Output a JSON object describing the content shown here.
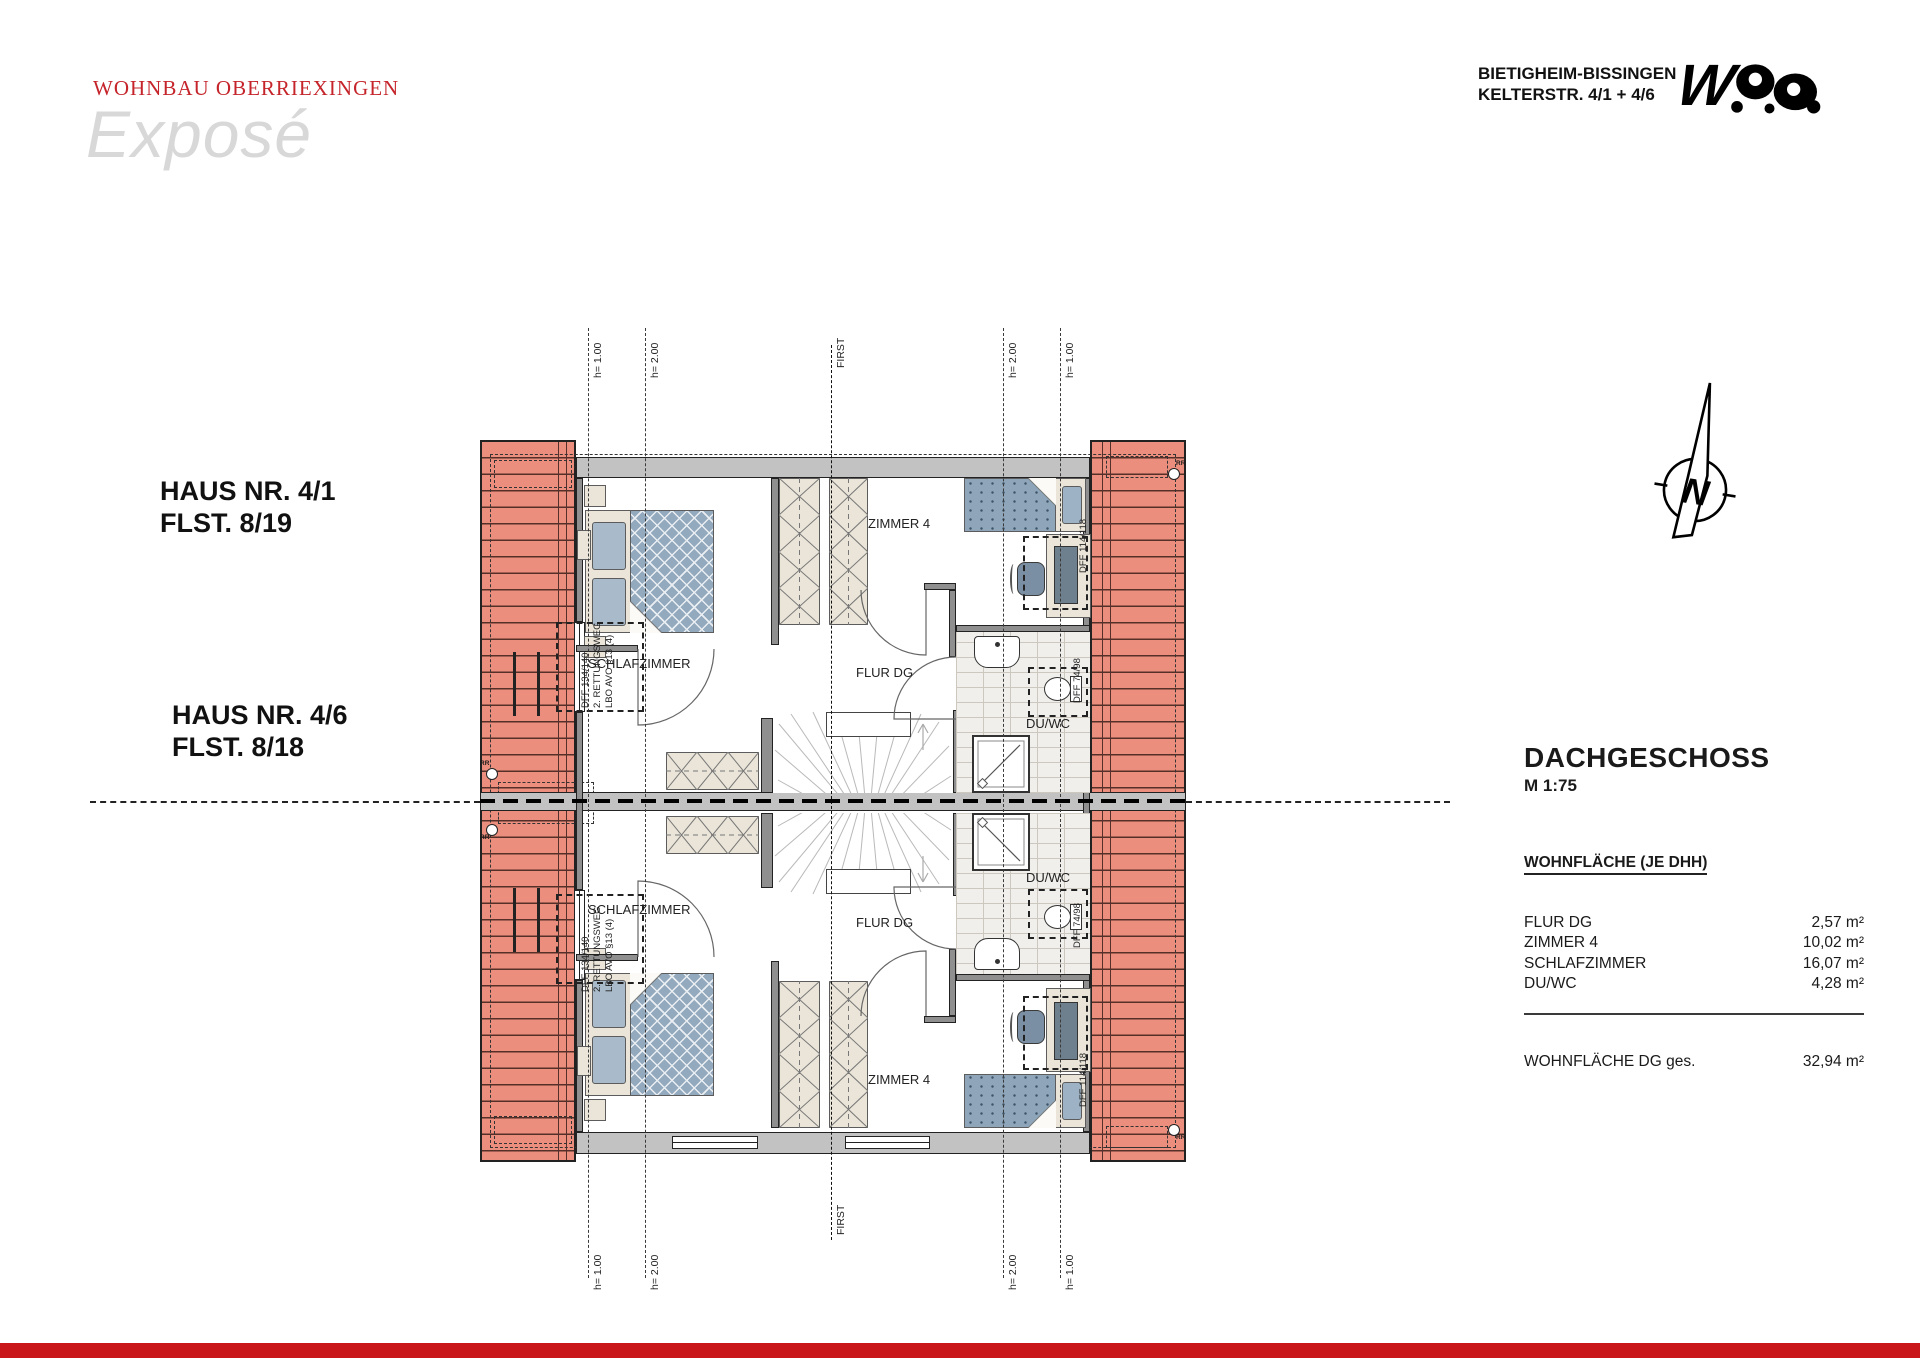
{
  "header": {
    "brand": "WOHNBAU OBERRIEXINGEN",
    "watermark": "Exposé",
    "location_line1": "BIETIGHEIM-BISSINGEN",
    "location_line2": "KELTERSTR. 4/1 + 4/6",
    "logo_text": "W"
  },
  "houses": [
    {
      "name": "HAUS NR. 4/1",
      "flst": "FLST. 8/19"
    },
    {
      "name": "HAUS NR. 4/6",
      "flst": "FLST. 8/18"
    }
  ],
  "plan": {
    "rooms": {
      "zimmer4": "ZIMMER 4",
      "schlafzimmer": "SCHLAFZIMMER",
      "flur": "FLUR DG",
      "duwc": "DU/WC"
    },
    "annotations": {
      "first": "FIRST",
      "h100": "h= 1.00",
      "h200": "h= 2.00",
      "rr": "RR",
      "dff_desk": "DFF 114/118",
      "dff_wc": "DFF 74/98",
      "rescue_line1": "DFF 134/140",
      "rescue_line2": "2. RETTUNGSWEG",
      "rescue_line3": "LBO AVO §13 (4)"
    }
  },
  "compass": {
    "letter": "N"
  },
  "info": {
    "title": "DACHGESCHOSS",
    "scale": "M 1:75",
    "table_heading": "WOHNFLÄCHE (JE DHH)",
    "rows": [
      {
        "label": "FLUR DG",
        "value": "2,57 m²"
      },
      {
        "label": "ZIMMER 4",
        "value": "10,02 m²"
      },
      {
        "label": "SCHLAFZIMMER",
        "value": "16,07 m²"
      },
      {
        "label": "DU/WC",
        "value": "4,28 m²"
      }
    ],
    "total_label": "WOHNFLÄCHE DG ges.",
    "total_value": "32,94 m²"
  },
  "colors": {
    "brand_red": "#c5242b",
    "bar_red": "#c8161b",
    "roof_salmon": "#ec8e7d"
  }
}
